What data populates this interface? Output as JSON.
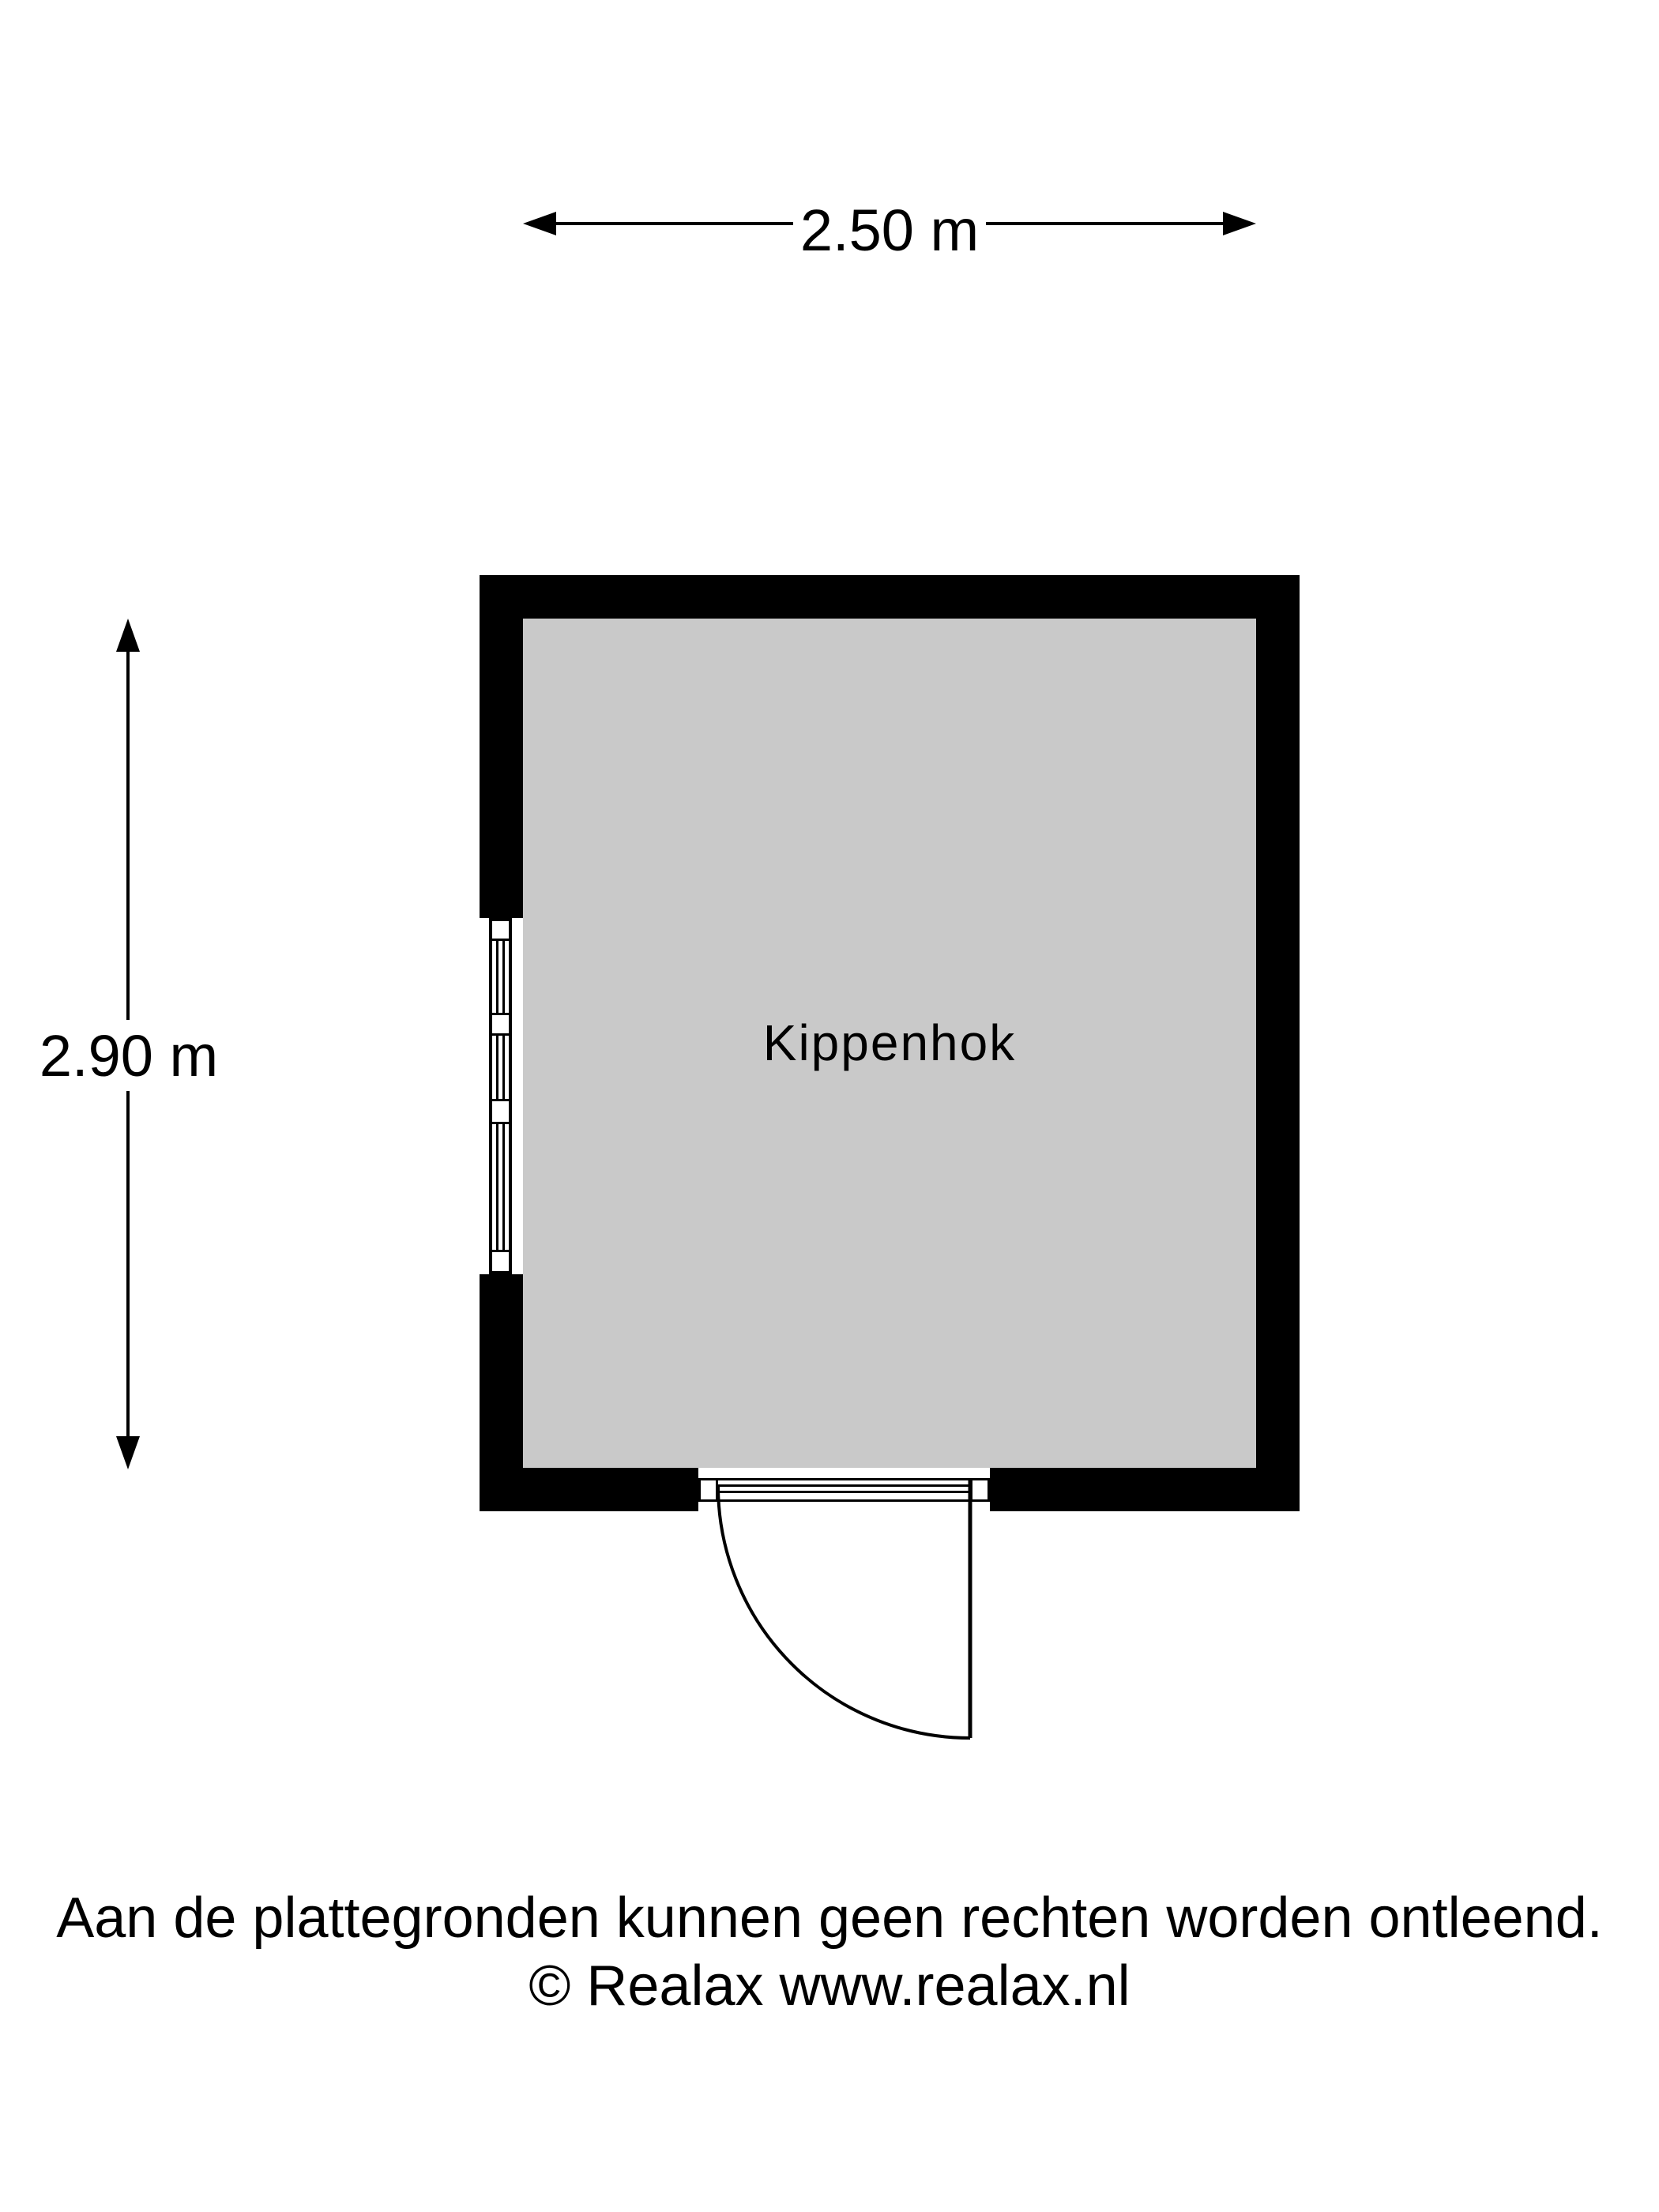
{
  "dimension_labels": {
    "width": "2.50 m",
    "height": "2.90 m"
  },
  "room": {
    "name": "Kippenhok"
  },
  "footer": {
    "disclaimer": "Aan de plattegronden kunnen geen rechten worden ontleend.",
    "copyright": "© Realax www.realax.nl"
  },
  "colors": {
    "wall": "#000000",
    "floor": "#c9c9c9",
    "background": "#ffffff",
    "ink": "#000000"
  }
}
